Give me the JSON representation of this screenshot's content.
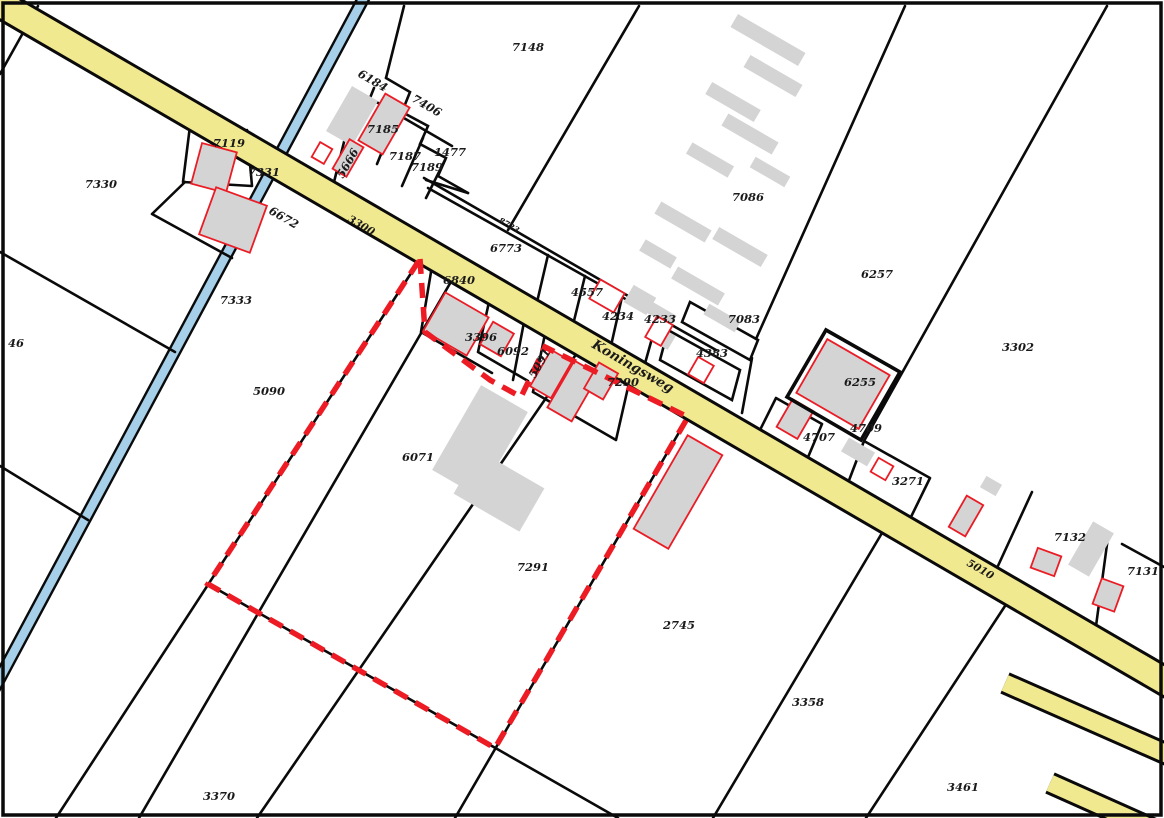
{
  "map": {
    "type": "cadastral-parcel-map",
    "street_name": "Koningsweg",
    "colors": {
      "road_fill": "#f1e990",
      "water_fill": "#a6cfe9",
      "building_fill": "#d4d4d4",
      "building_outline": "#ea1c25",
      "selection_dash": "#ed1c24",
      "boundary_line": "#0a0a0a",
      "street_label": "#4a473c"
    },
    "selection_outline": {
      "description": "red dashed highlighted parcel boundary",
      "path": "M 420 259 L 425 332 L 490 380 L 521 397 L 545 347 L 688 417 L 495 748 L 208 584 Z"
    },
    "labels": [
      {
        "t": "7330",
        "x": 85,
        "y": 188,
        "r": 0,
        "k": "p"
      },
      {
        "t": "7119",
        "x": 213,
        "y": 147,
        "r": 0,
        "k": "p"
      },
      {
        "t": "7331",
        "x": 248,
        "y": 176,
        "r": 0,
        "k": "p"
      },
      {
        "t": "6672",
        "x": 268,
        "y": 213,
        "r": 30,
        "k": "p"
      },
      {
        "t": "6184",
        "x": 357,
        "y": 76,
        "r": 30,
        "k": "p"
      },
      {
        "t": "7406",
        "x": 411,
        "y": 101,
        "r": 30,
        "k": "p"
      },
      {
        "t": "7185",
        "x": 367,
        "y": 133,
        "r": 0,
        "k": "p"
      },
      {
        "t": "5666",
        "x": 343,
        "y": 179,
        "r": -60,
        "k": "p"
      },
      {
        "t": "7187",
        "x": 389,
        "y": 160,
        "r": 0,
        "k": "p"
      },
      {
        "t": "7189",
        "x": 411,
        "y": 171,
        "r": 0,
        "k": "p"
      },
      {
        "t": "1477",
        "x": 434,
        "y": 156,
        "r": 0,
        "k": "p"
      },
      {
        "t": "3300",
        "x": 347,
        "y": 221,
        "r": 30,
        "k": "road"
      },
      {
        "t": "7148",
        "x": 512,
        "y": 51,
        "r": 0,
        "k": "p"
      },
      {
        "t": "8723",
        "x": 498,
        "y": 222,
        "r": 30,
        "k": "tiny"
      },
      {
        "t": "6773",
        "x": 490,
        "y": 252,
        "r": 0,
        "k": "p"
      },
      {
        "t": "7086",
        "x": 732,
        "y": 201,
        "r": 0,
        "k": "p"
      },
      {
        "t": "4557",
        "x": 571,
        "y": 296,
        "r": 0,
        "k": "p"
      },
      {
        "t": "4234",
        "x": 602,
        "y": 320,
        "r": 0,
        "k": "p"
      },
      {
        "t": "4233",
        "x": 644,
        "y": 323,
        "r": 0,
        "k": "p"
      },
      {
        "t": "7083",
        "x": 728,
        "y": 323,
        "r": 0,
        "k": "p"
      },
      {
        "t": "4383",
        "x": 696,
        "y": 357,
        "r": 0,
        "k": "p"
      },
      {
        "t": "6257",
        "x": 861,
        "y": 278,
        "r": 0,
        "k": "p"
      },
      {
        "t": "3302",
        "x": 1002,
        "y": 351,
        "r": 0,
        "k": "p"
      },
      {
        "t": "6840",
        "x": 443,
        "y": 284,
        "r": 0,
        "k": "p"
      },
      {
        "t": "3396",
        "x": 465,
        "y": 341,
        "r": 0,
        "k": "p"
      },
      {
        "t": "6092",
        "x": 497,
        "y": 355,
        "r": 0,
        "k": "p"
      },
      {
        "t": "5091",
        "x": 535,
        "y": 379,
        "r": -60,
        "k": "p"
      },
      {
        "t": "Koningsweg",
        "x": 591,
        "y": 347,
        "r": 30,
        "k": "street"
      },
      {
        "t": "7290",
        "x": 607,
        "y": 386,
        "r": 0,
        "k": "p"
      },
      {
        "t": "6255",
        "x": 844,
        "y": 386,
        "r": 0,
        "k": "p"
      },
      {
        "t": "4707",
        "x": 803,
        "y": 441,
        "r": 0,
        "k": "p"
      },
      {
        "t": "4709",
        "x": 850,
        "y": 432,
        "r": 0,
        "k": "p"
      },
      {
        "t": "3271",
        "x": 892,
        "y": 485,
        "r": 0,
        "k": "p"
      },
      {
        "t": "5010",
        "x": 966,
        "y": 565,
        "r": 30,
        "k": "road"
      },
      {
        "t": "7132",
        "x": 1054,
        "y": 541,
        "r": 0,
        "k": "p"
      },
      {
        "t": "7131",
        "x": 1127,
        "y": 575,
        "r": 0,
        "k": "p"
      },
      {
        "t": "5090",
        "x": 253,
        "y": 395,
        "r": 0,
        "k": "p"
      },
      {
        "t": "46",
        "x": 8,
        "y": 347,
        "r": 0,
        "k": "p"
      },
      {
        "t": "7333",
        "x": 220,
        "y": 304,
        "r": 0,
        "k": "p"
      },
      {
        "t": "6071",
        "x": 402,
        "y": 461,
        "r": 0,
        "k": "p"
      },
      {
        "t": "7291",
        "x": 517,
        "y": 571,
        "r": 0,
        "k": "p"
      },
      {
        "t": "2745",
        "x": 663,
        "y": 629,
        "r": 0,
        "k": "p"
      },
      {
        "t": "3358",
        "x": 792,
        "y": 706,
        "r": 0,
        "k": "p"
      },
      {
        "t": "3461",
        "x": 947,
        "y": 791,
        "r": 0,
        "k": "p"
      },
      {
        "t": "3370",
        "x": 203,
        "y": 800,
        "r": 0,
        "k": "p"
      }
    ],
    "buildings": [
      {
        "cx": 352,
        "cy": 116,
        "w": 30,
        "h": 52,
        "rot": 30,
        "s": "g"
      },
      {
        "cx": 384,
        "cy": 124,
        "w": 28,
        "h": 54,
        "rot": 30,
        "s": "gr"
      },
      {
        "cx": 322,
        "cy": 153,
        "w": 14,
        "h": 17,
        "rot": 30,
        "s": "wr"
      },
      {
        "cx": 348,
        "cy": 158,
        "w": 16,
        "h": 34,
        "rot": 30,
        "s": "gr"
      },
      {
        "cx": 214,
        "cy": 168,
        "w": 36,
        "h": 42,
        "rot": 15,
        "s": "gr"
      },
      {
        "cx": 233,
        "cy": 220,
        "w": 54,
        "h": 50,
        "rot": 20,
        "s": "gr"
      },
      {
        "cx": 456,
        "cy": 324,
        "w": 50,
        "h": 44,
        "rot": 30,
        "s": "gr"
      },
      {
        "cx": 497,
        "cy": 339,
        "w": 24,
        "h": 26,
        "rot": 30,
        "s": "gr"
      },
      {
        "cx": 551,
        "cy": 374,
        "w": 24,
        "h": 42,
        "rot": 30,
        "s": "gr"
      },
      {
        "cx": 573,
        "cy": 391,
        "w": 28,
        "h": 54,
        "rot": 30,
        "s": "gr"
      },
      {
        "cx": 601,
        "cy": 381,
        "w": 22,
        "h": 30,
        "rot": 30,
        "s": "gr"
      },
      {
        "cx": 480,
        "cy": 441,
        "w": 54,
        "h": 98,
        "rot": 30,
        "s": "g"
      },
      {
        "cx": 499,
        "cy": 491,
        "w": 76,
        "h": 50,
        "rot": 30,
        "s": "g"
      },
      {
        "cx": 678,
        "cy": 492,
        "w": 40,
        "h": 108,
        "rot": 30,
        "s": "gr"
      },
      {
        "cx": 768,
        "cy": 40,
        "w": 78,
        "h": 15,
        "rot": 30,
        "s": "g"
      },
      {
        "cx": 773,
        "cy": 76,
        "w": 60,
        "h": 14,
        "rot": 30,
        "s": "g"
      },
      {
        "cx": 733,
        "cy": 102,
        "w": 56,
        "h": 14,
        "rot": 30,
        "s": "g"
      },
      {
        "cx": 750,
        "cy": 134,
        "w": 58,
        "h": 14,
        "rot": 30,
        "s": "g"
      },
      {
        "cx": 710,
        "cy": 160,
        "w": 48,
        "h": 13,
        "rot": 30,
        "s": "g"
      },
      {
        "cx": 770,
        "cy": 172,
        "w": 40,
        "h": 12,
        "rot": 30,
        "s": "g"
      },
      {
        "cx": 683,
        "cy": 222,
        "w": 58,
        "h": 14,
        "rot": 30,
        "s": "g"
      },
      {
        "cx": 740,
        "cy": 247,
        "w": 56,
        "h": 14,
        "rot": 30,
        "s": "g"
      },
      {
        "cx": 658,
        "cy": 254,
        "w": 36,
        "h": 13,
        "rot": 30,
        "s": "g"
      },
      {
        "cx": 698,
        "cy": 286,
        "w": 54,
        "h": 14,
        "rot": 30,
        "s": "g"
      },
      {
        "cx": 658,
        "cy": 312,
        "w": 36,
        "h": 12,
        "rot": 30,
        "s": "g"
      },
      {
        "cx": 722,
        "cy": 318,
        "w": 36,
        "h": 12,
        "rot": 30,
        "s": "g"
      },
      {
        "cx": 640,
        "cy": 300,
        "w": 26,
        "h": 20,
        "rot": 30,
        "s": "g"
      },
      {
        "cx": 663,
        "cy": 338,
        "w": 20,
        "h": 16,
        "rot": 30,
        "s": "g"
      },
      {
        "cx": 607,
        "cy": 296,
        "w": 28,
        "h": 22,
        "rot": 30,
        "s": "wr"
      },
      {
        "cx": 659,
        "cy": 331,
        "w": 18,
        "h": 24,
        "rot": 30,
        "s": "wr"
      },
      {
        "cx": 701,
        "cy": 370,
        "w": 18,
        "h": 20,
        "rot": 30,
        "s": "wr"
      },
      {
        "cx": 843,
        "cy": 384,
        "w": 72,
        "h": 62,
        "rot": 30,
        "s": "gr"
      },
      {
        "cx": 795,
        "cy": 419,
        "w": 24,
        "h": 32,
        "rot": 30,
        "s": "gr"
      },
      {
        "cx": 858,
        "cy": 452,
        "w": 30,
        "h": 16,
        "rot": 30,
        "s": "g"
      },
      {
        "cx": 882,
        "cy": 469,
        "w": 17,
        "h": 16,
        "rot": 30,
        "s": "wr"
      },
      {
        "cx": 966,
        "cy": 516,
        "w": 19,
        "h": 36,
        "rot": 30,
        "s": "gr"
      },
      {
        "cx": 991,
        "cy": 486,
        "w": 18,
        "h": 13,
        "rot": 30,
        "s": "g"
      },
      {
        "cx": 1046,
        "cy": 562,
        "w": 25,
        "h": 21,
        "rot": 20,
        "s": "gr"
      },
      {
        "cx": 1091,
        "cy": 549,
        "w": 24,
        "h": 50,
        "rot": 30,
        "s": "g"
      },
      {
        "cx": 1108,
        "cy": 595,
        "w": 23,
        "h": 27,
        "rot": 20,
        "s": "gr"
      }
    ]
  }
}
